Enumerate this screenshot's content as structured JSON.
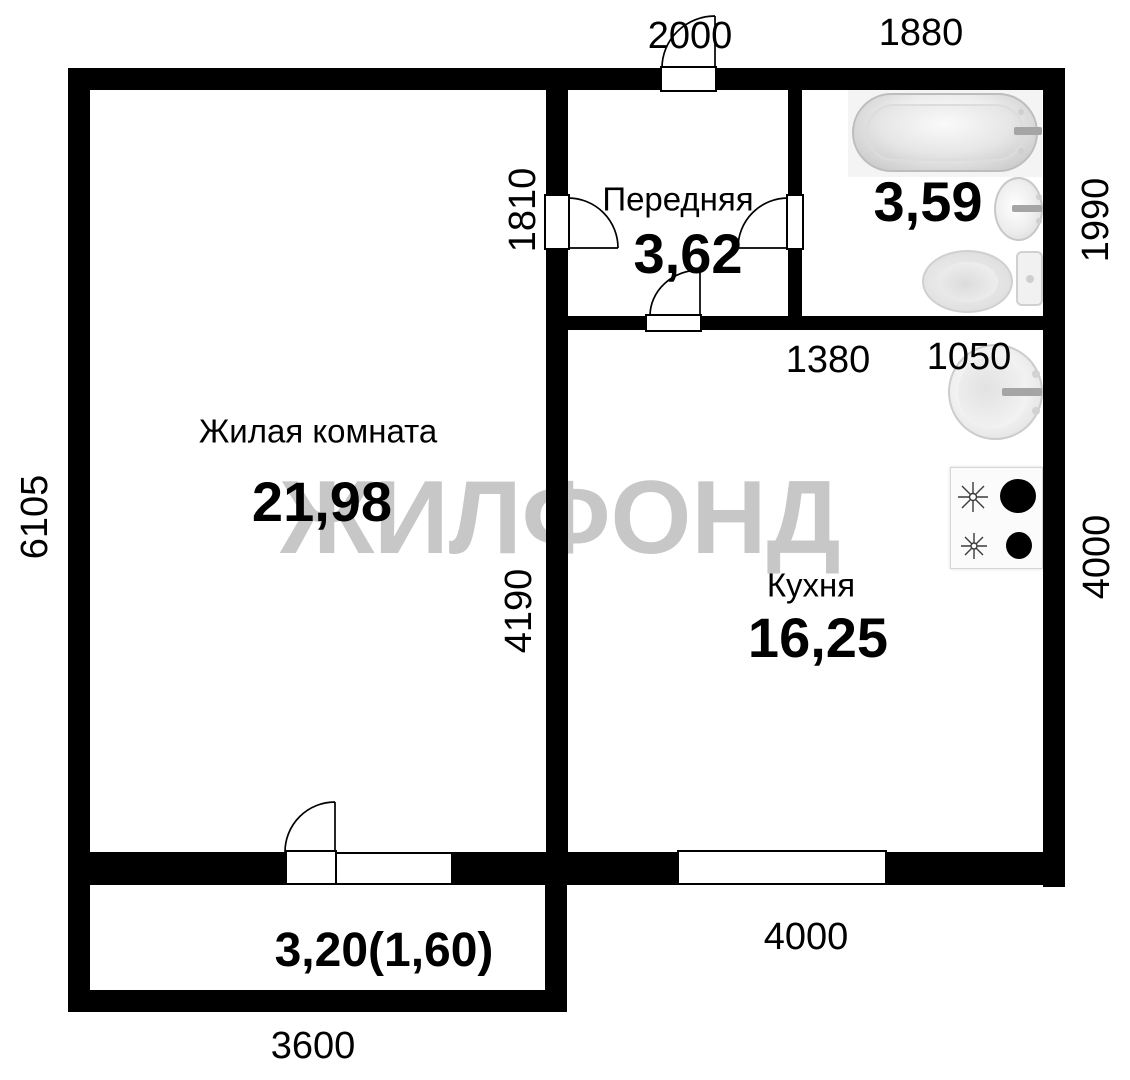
{
  "watermark": "ЖИЛФОНД",
  "rooms": {
    "living": {
      "name": "Жилая комната",
      "area": "21,98"
    },
    "hallway": {
      "name": "Передняя",
      "area": "3,62"
    },
    "kitchen": {
      "name": "Кухня",
      "area": "16,25"
    },
    "bathroom": {
      "area": "3,59"
    },
    "balcony": {
      "area": "3,20(1,60)"
    }
  },
  "dimensions_mm": {
    "top_entrance": "2000",
    "top_bathroom": "1880",
    "bathroom_right": "1990",
    "kitchen_right": "4000",
    "living_left": "6105",
    "hall_door": "1810",
    "living_inner": "4190",
    "kitchen_top_left": "1380",
    "kitchen_top_right": "1050",
    "kitchen_bottom": "4000",
    "balcony_bottom": "3600"
  },
  "fixtures": [
    "bathtub",
    "bathroom-sink",
    "toilet",
    "kitchen-sink",
    "gas-stove"
  ],
  "colors": {
    "wall": "#000000",
    "bg": "#ffffff",
    "watermark": "#c7c7c7",
    "fixture-outline": "#bdbdbd",
    "burner": "#000000"
  }
}
